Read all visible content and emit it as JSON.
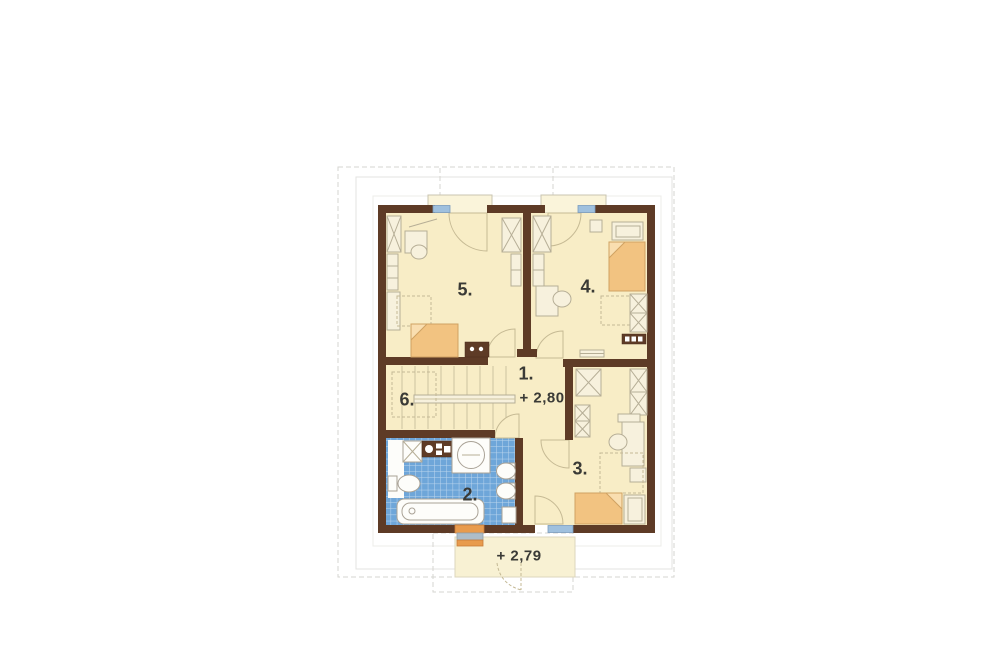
{
  "rooms": {
    "hall": {
      "number": "1."
    },
    "bathroom": {
      "number": "2."
    },
    "bedroom_right": {
      "number": "3."
    },
    "bedroom_top_right": {
      "number": "4."
    },
    "bedroom_top_left": {
      "number": "5."
    },
    "staircase": {
      "number": "6."
    }
  },
  "levels": {
    "floor": "+ 2,80",
    "balcony": "+ 2,79"
  },
  "colors": {
    "wall": "#5e3b26",
    "floor": "#f8edc6",
    "fixture": "#f7f1dd",
    "tile": "#6ea6d9",
    "bed": "#f2c381",
    "bedfold": "#f9deb0",
    "window": "#9fc0de",
    "frameorange": "#e89b4d",
    "label": "#3a3a36"
  }
}
